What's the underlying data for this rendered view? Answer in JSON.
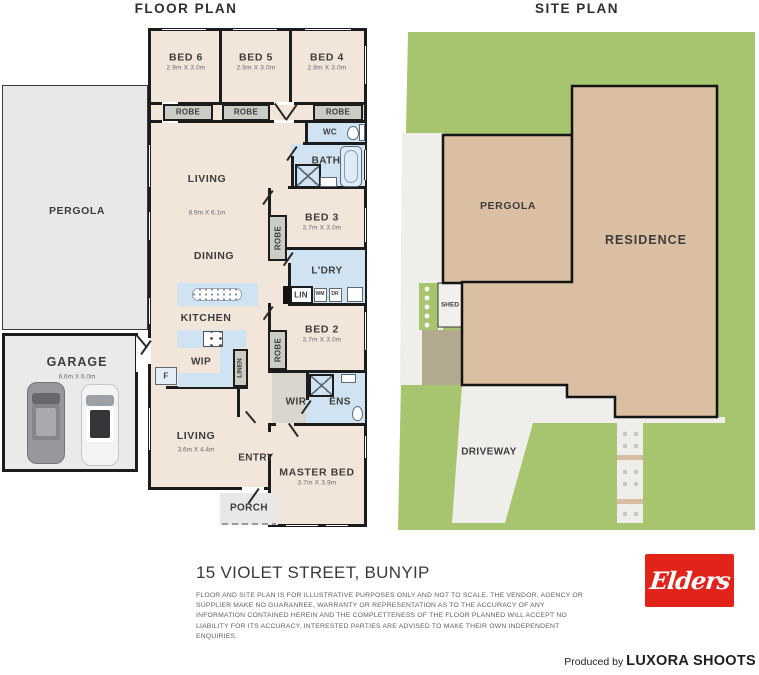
{
  "titles": {
    "floor_plan": "FLOOR PLAN",
    "site_plan": "SITE PLAN"
  },
  "colors": {
    "wall": "#1c1c1c",
    "room_fill": "#f2e5da",
    "wet_area": "#cfe3f2",
    "robe_gray": "#ccccc6",
    "outdoor_gray": "#e8e8e8",
    "garage_gray": "#eaeaea",
    "wir_gray": "#d9d6ce",
    "grass_green": "#a7c46e",
    "building_tan": "#dabfa3",
    "concrete": "#efeeeb",
    "yard_brown": "#b3a98f",
    "brand_red": "#e2231a",
    "white": "#ffffff"
  },
  "floor_plan": {
    "labels": [
      {
        "name": "bed6",
        "text": "BED 6",
        "sub": "2.9m X 3.0m",
        "x": 186,
        "y": 62,
        "cls": "room"
      },
      {
        "name": "bed5",
        "text": "BED 5",
        "sub": "2.9m X 3.0m",
        "x": 256,
        "y": 62,
        "cls": "room"
      },
      {
        "name": "bed4",
        "text": "BED 4",
        "sub": "2.9m X 3.0m",
        "x": 327,
        "y": 62,
        "cls": "room"
      },
      {
        "name": "robe-bed6",
        "text": "ROBE",
        "x": 188,
        "y": 112,
        "cls": "small"
      },
      {
        "name": "robe-bed5",
        "text": "ROBE",
        "x": 246,
        "y": 112,
        "cls": "small"
      },
      {
        "name": "robe-bed4",
        "text": "ROBE",
        "x": 338,
        "y": 112,
        "cls": "small"
      },
      {
        "name": "living-main",
        "text": "LIVING",
        "x": 207,
        "y": 179,
        "cls": "room"
      },
      {
        "name": "living-main-dims",
        "text": "8.9m X 6.1m",
        "x": 207,
        "y": 213,
        "cls": "dims"
      },
      {
        "name": "wc",
        "text": "WC",
        "x": 330,
        "y": 132,
        "cls": "small"
      },
      {
        "name": "bath",
        "text": "BATH",
        "x": 326,
        "y": 161,
        "cls": "med"
      },
      {
        "name": "bed3",
        "text": "BED 3",
        "sub": "3.7m X 3.0m",
        "x": 322,
        "y": 222,
        "cls": "room"
      },
      {
        "name": "robe-bed3",
        "text": "ROBE",
        "x": 278,
        "y": 238,
        "cls": "small vert"
      },
      {
        "name": "dining",
        "text": "DINING",
        "x": 214,
        "y": 256,
        "cls": "room"
      },
      {
        "name": "laundry",
        "text": "L'DRY",
        "x": 327,
        "y": 271,
        "cls": "med"
      },
      {
        "name": "lin",
        "text": "LIN",
        "x": 301,
        "y": 295,
        "cls": "small"
      },
      {
        "name": "wm",
        "text": "WM",
        "x": 320,
        "y": 295,
        "cls": "tiny"
      },
      {
        "name": "dr",
        "text": "DR",
        "x": 335,
        "y": 295,
        "cls": "tiny"
      },
      {
        "name": "kitchen",
        "text": "KITCHEN",
        "x": 206,
        "y": 318,
        "cls": "room"
      },
      {
        "name": "wip",
        "text": "WIP",
        "x": 201,
        "y": 362,
        "cls": "med"
      },
      {
        "name": "fridge",
        "text": "F",
        "x": 166,
        "y": 376,
        "cls": "small"
      },
      {
        "name": "linen",
        "text": "LINEN",
        "x": 240,
        "y": 368,
        "cls": "micro vert"
      },
      {
        "name": "robe-bed2",
        "text": "ROBE",
        "x": 278,
        "y": 350,
        "cls": "small vert"
      },
      {
        "name": "bed2",
        "text": "BED 2",
        "sub": "3.7m X 3.0m",
        "x": 322,
        "y": 334,
        "cls": "room"
      },
      {
        "name": "wir",
        "text": "WIR",
        "x": 296,
        "y": 402,
        "cls": "med"
      },
      {
        "name": "ens",
        "text": "ENS",
        "x": 340,
        "y": 402,
        "cls": "med"
      },
      {
        "name": "living2",
        "text": "LIVING",
        "x": 196,
        "y": 436,
        "cls": "room"
      },
      {
        "name": "living2-dims",
        "text": "3.6m X 4.4m",
        "x": 196,
        "y": 450,
        "cls": "dims"
      },
      {
        "name": "entry",
        "text": "ENTRY",
        "x": 256,
        "y": 458,
        "cls": "med"
      },
      {
        "name": "master-bed",
        "text": "MASTER BED",
        "sub": "3.7m X 3.9m",
        "x": 317,
        "y": 477,
        "cls": "room"
      },
      {
        "name": "porch",
        "text": "PORCH",
        "x": 249,
        "y": 508,
        "cls": "med"
      },
      {
        "name": "garage",
        "text": "GARAGE",
        "x": 77,
        "y": 362,
        "cls": "room-lg"
      },
      {
        "name": "garage-dims",
        "text": "6.6m X 6.0m",
        "x": 77,
        "y": 377,
        "cls": "dims"
      },
      {
        "name": "pergola-floor",
        "text": "PERGOLA",
        "x": 77,
        "y": 211,
        "cls": "room"
      }
    ]
  },
  "site_plan": {
    "labels": [
      {
        "name": "pergola-site",
        "text": "PERGOLA",
        "x": 508,
        "y": 206,
        "cls": "room"
      },
      {
        "name": "residence",
        "text": "RESIDENCE",
        "x": 646,
        "y": 240,
        "cls": "room-lg"
      },
      {
        "name": "shed",
        "text": "SHED",
        "x": 450,
        "y": 305,
        "cls": "micro"
      },
      {
        "name": "driveway",
        "text": "DRIVEWAY",
        "x": 489,
        "y": 452,
        "cls": "med"
      }
    ]
  },
  "footer": {
    "address": "15 VIOLET STREET, BUNYIP",
    "disclaimer": "FLOOR AND SITE PLAN IS FOR ILLUSTRATIVE PURPOSES ONLY AND NOT TO SCALE. THE VENDOR, AGENCY OR SUPPLIER MAKE NO GUARANREE, WARRANTY OR REPRESENTATION AS TO THE ACCURACY OF ANY INFORMATION CONTAINED HEREIN AND THE COMPLETTENESS OF THE FLOOR PLANNED WILL ACCEPT NO LIABILITY FOR ITS ACCURACY. INTERESTED PARTIES ARE ADVISED TO MAKE THEIR OWN INDEPENDENT ENQUIRIES.",
    "agency_logo_text": "Elders",
    "produced_by": "Produced by ",
    "producer": "LUXORA SHOOTS"
  }
}
